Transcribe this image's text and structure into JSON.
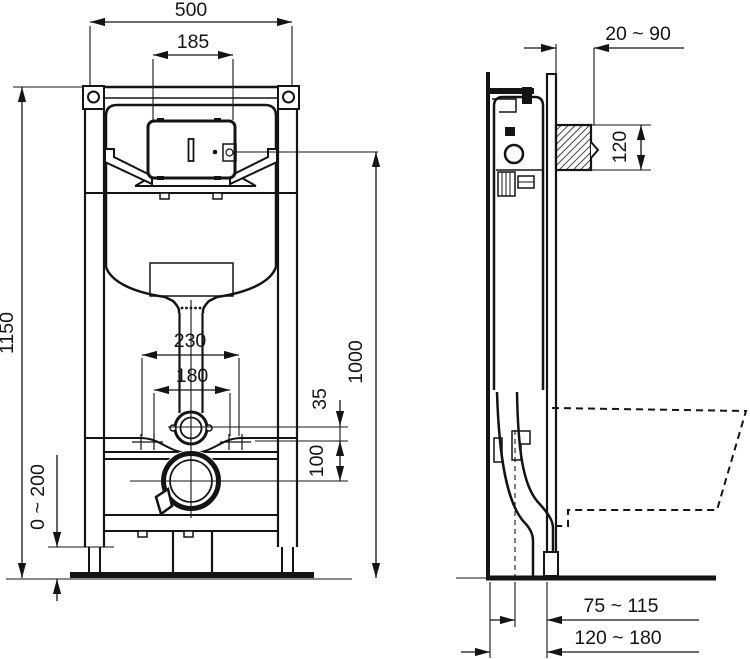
{
  "drawing": {
    "kind": "wc-installation-frame-technical-diagram",
    "views": {
      "front": {
        "dims": {
          "frame_width": "500",
          "panel_opening_width": "185",
          "frame_height": "1150",
          "actuator_center_height": "1000",
          "fixing_spacing_outer": "230",
          "fixing_spacing_inner": "180",
          "flushpipe_to_fixings": "35",
          "fixings_to_outlet": "100",
          "foot_adjustment": "0 ~ 200"
        }
      },
      "side": {
        "dims": {
          "installation_depth": "20 ~ 90",
          "actuator_opening_height": "120",
          "outlet_center_to_front": "75 ~ 115",
          "outlet_center_to_wall": "120 ~ 180"
        }
      }
    }
  },
  "colors": {
    "line": "#141414",
    "background": "#ffffff"
  }
}
